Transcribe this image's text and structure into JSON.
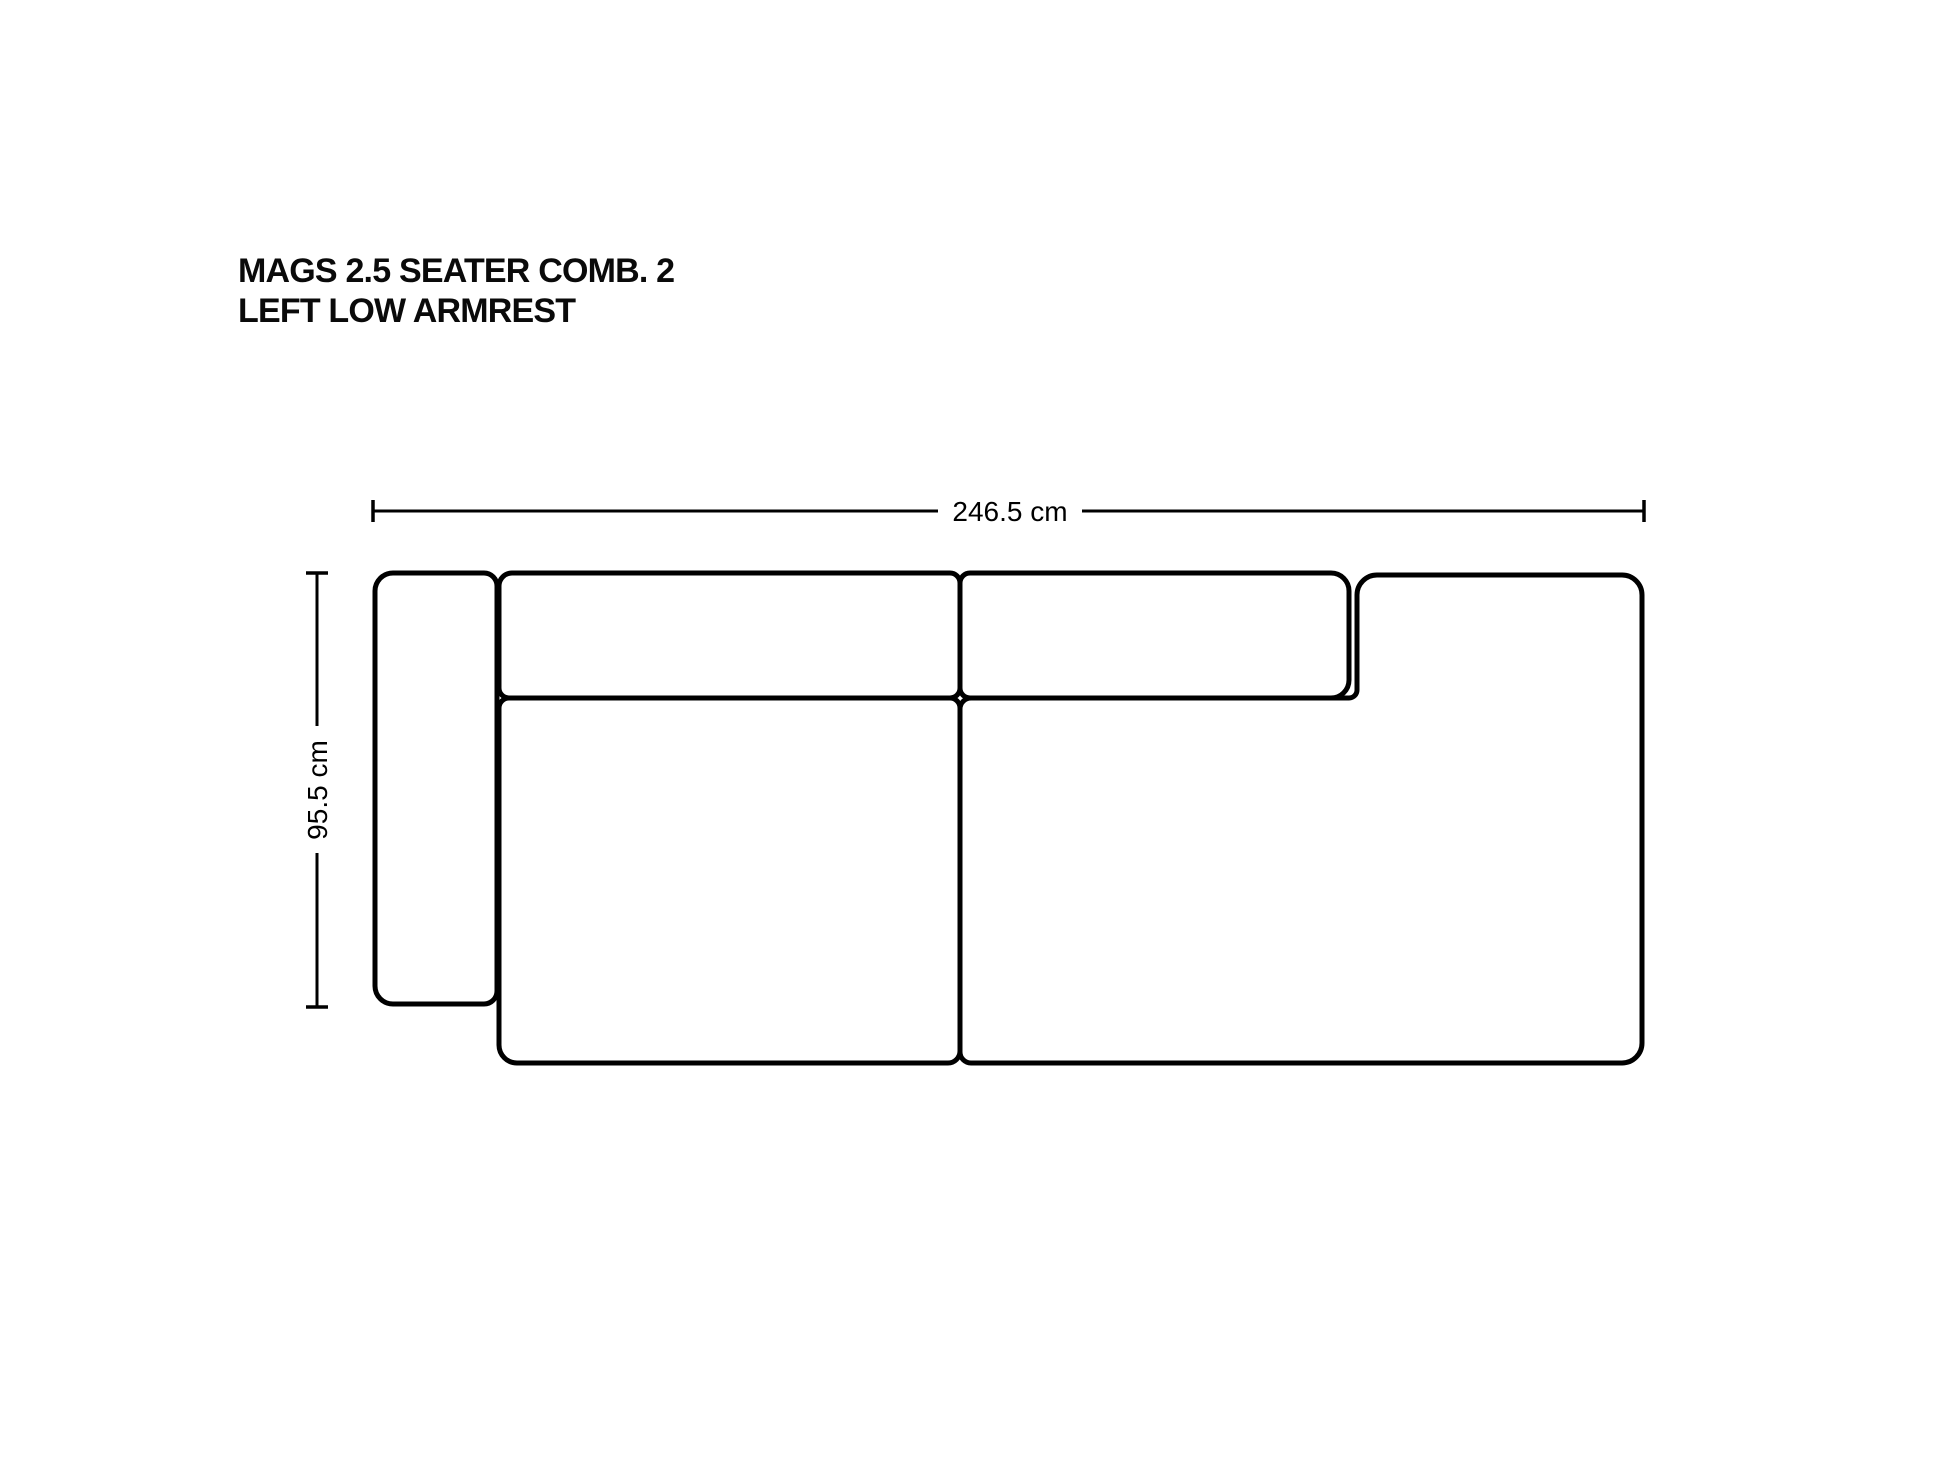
{
  "title": {
    "line1": "MAGS 2.5 SEATER COMB. 2",
    "line2": "LEFT LOW ARMREST"
  },
  "dimensions": {
    "width": {
      "label": "246.5 cm"
    },
    "depth": {
      "label": "95.5 cm"
    }
  },
  "colors": {
    "ink": "#000000",
    "background": "#FFFFFF"
  }
}
